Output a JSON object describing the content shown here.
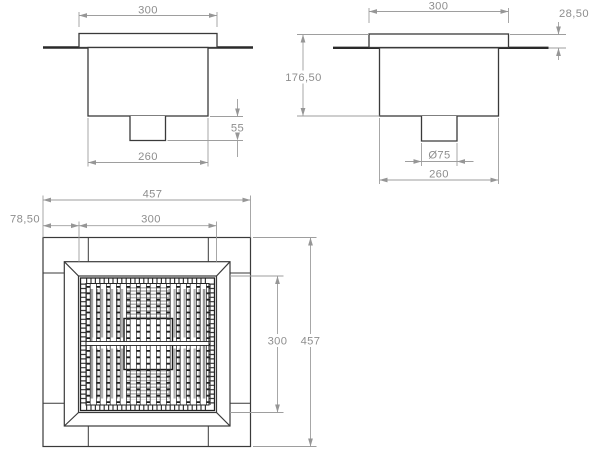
{
  "meta": {
    "type": "technical-drawing",
    "subject": "square floor drain, three orthographic views"
  },
  "colors": {
    "geometry": "#3a3a3a",
    "grate": "#222222",
    "slot_fill": "#b0b0b0",
    "dimension": "#9a9a9a",
    "dim_text": "#8e8e8e",
    "background": "#ffffff"
  },
  "views": {
    "front": {
      "name": "front-elevation",
      "dims": {
        "top_width": "300",
        "outlet_depth": "55",
        "body_width": "260"
      }
    },
    "side": {
      "name": "side-elevation",
      "dims": {
        "top_width": "300",
        "rim_height": "28,50",
        "overall_height": "176,50",
        "pipe_diameter": "Ø75",
        "body_width": "260"
      }
    },
    "plan": {
      "name": "plan-view",
      "dims": {
        "outer_width": "457",
        "edge_offset": "78,50",
        "opening_width": "300",
        "opening_height": "300",
        "outer_height": "457"
      }
    }
  }
}
